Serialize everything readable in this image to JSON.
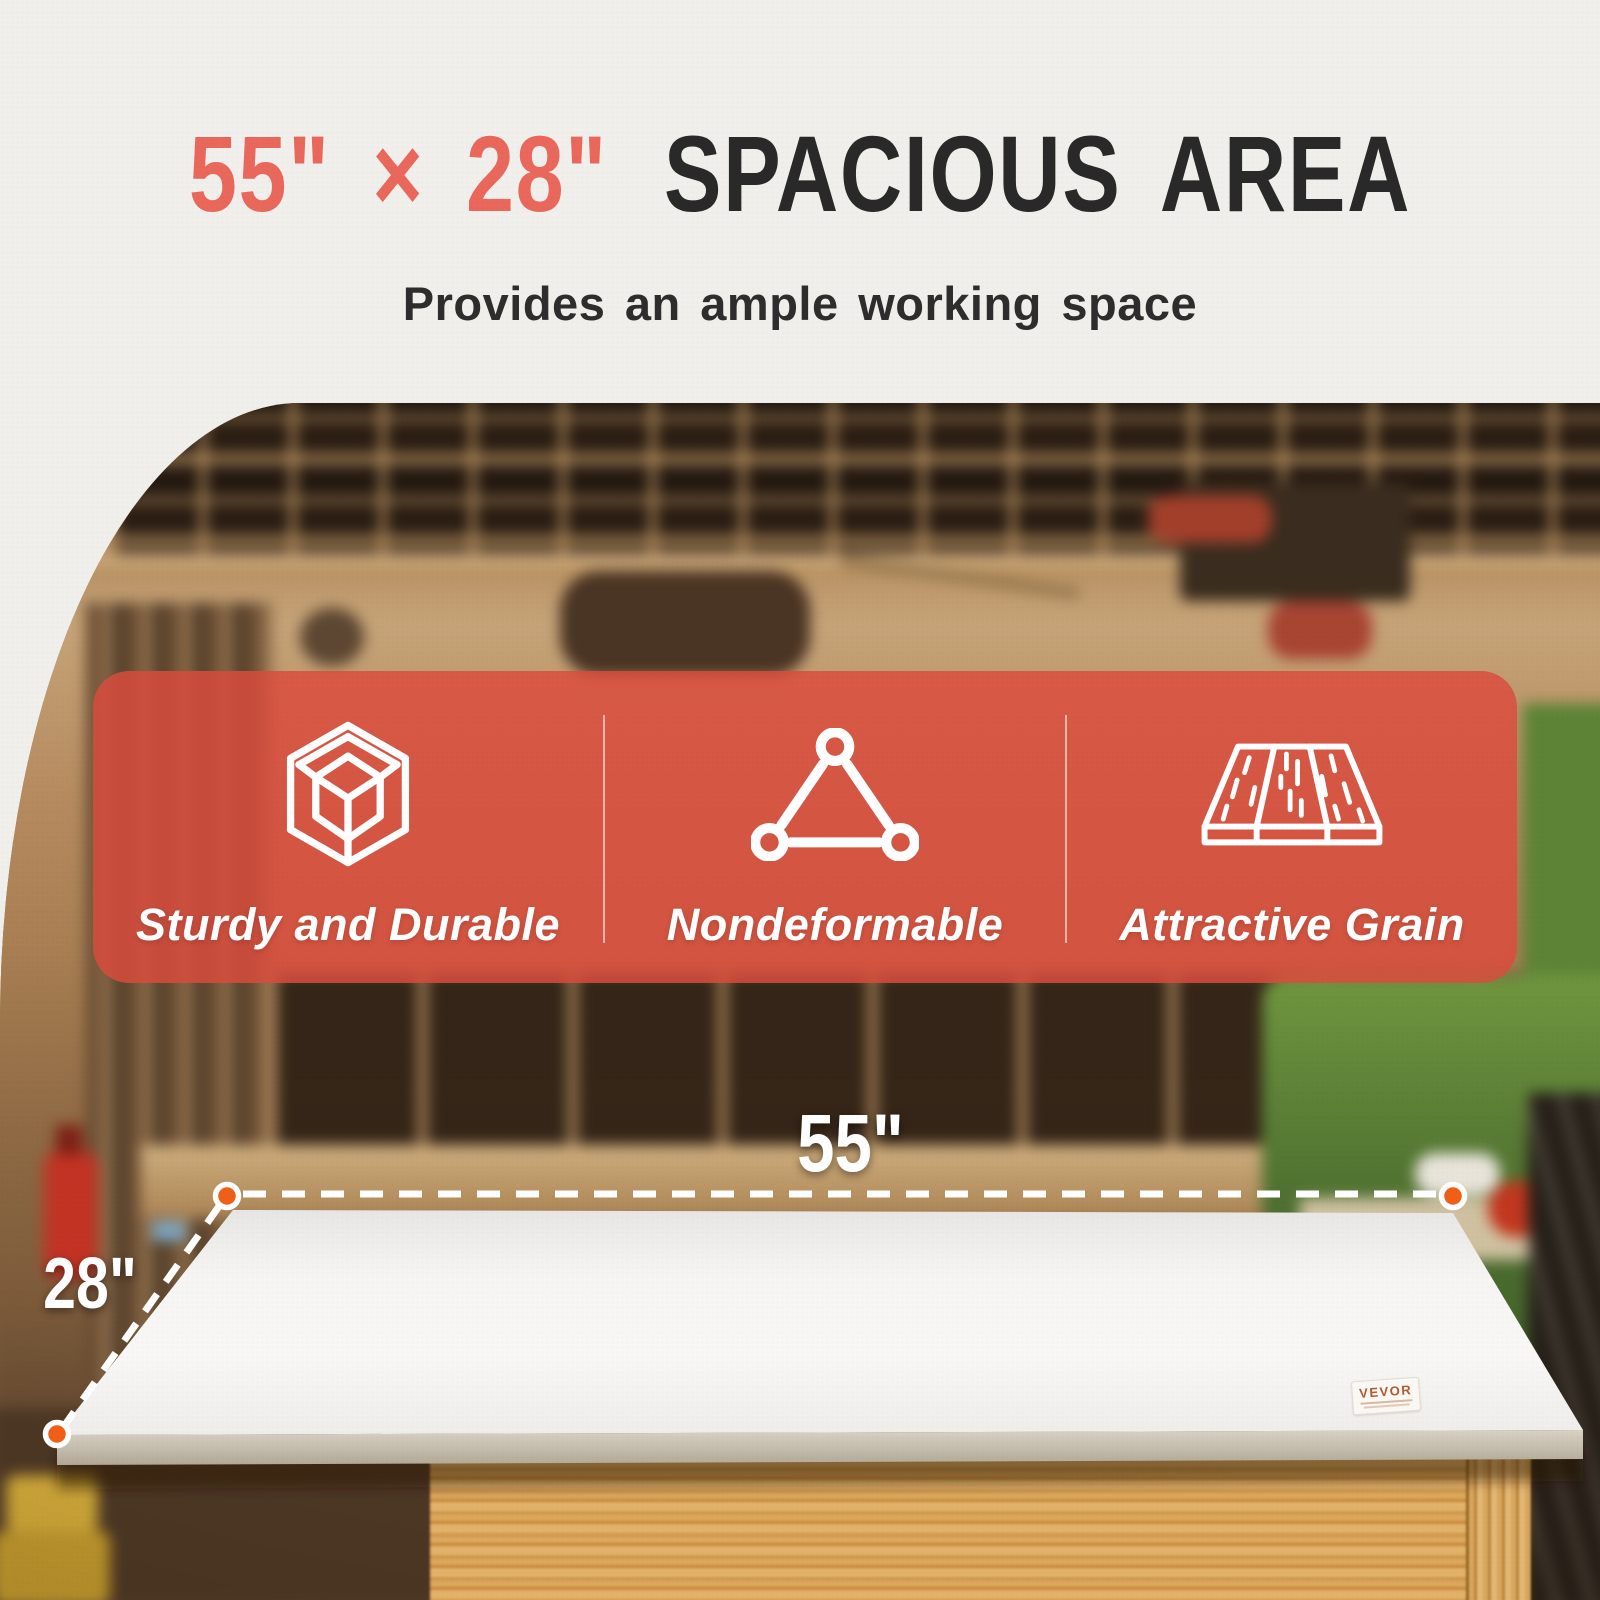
{
  "page": {
    "title": {
      "highlight": "55\" × 28\"",
      "rest": "SPACIOUS AREA"
    },
    "subtitle": "Provides an ample working space"
  },
  "features": [
    {
      "icon": "cube-wireframe-icon",
      "label": "Sturdy and Durable"
    },
    {
      "icon": "triangle-nodes-icon",
      "label": "Nondeformable"
    },
    {
      "icon": "wood-planks-icon",
      "label": "Attractive Grain"
    }
  ],
  "dimensions": {
    "width_label": "55\"",
    "depth_label": "28\""
  },
  "brand": {
    "sticker_label": "VEVOR"
  },
  "colors": {
    "accent_red": "#e9685b",
    "banner_red": "#db4c3d",
    "title_dark": "#2a2929",
    "marker_orange": "#f05e18",
    "tabletop_white": "#f6f5f3",
    "pine_wood": "#d8a75e"
  }
}
